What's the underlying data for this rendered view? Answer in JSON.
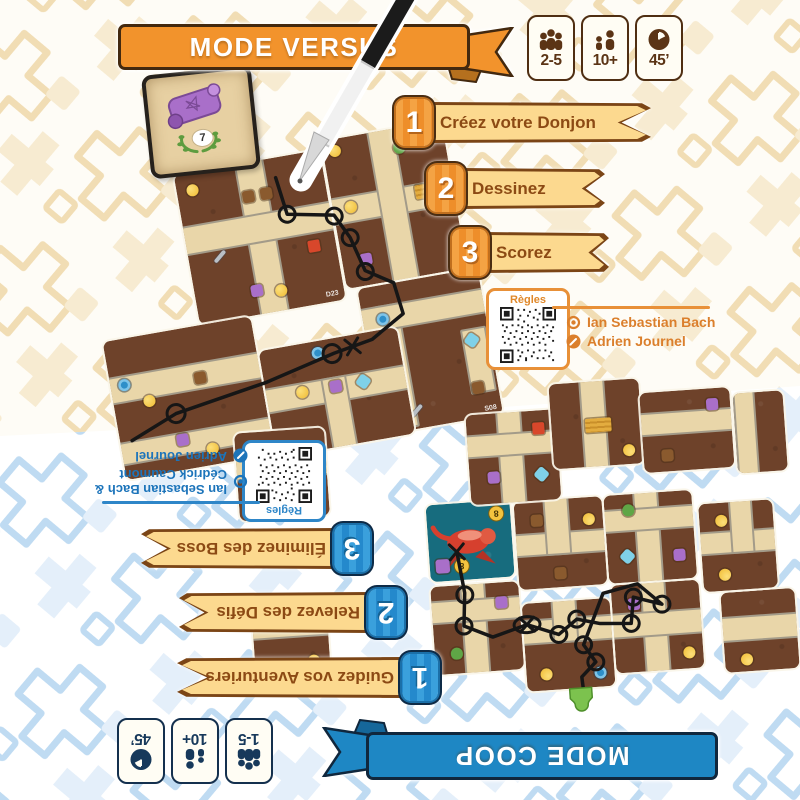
{
  "versus": {
    "banner_label": "MODE VERSUS",
    "theme_color": "#F2932C",
    "badges": [
      {
        "icon": "players-icon",
        "label": "2-5"
      },
      {
        "icon": "age-icon",
        "label": "10+"
      },
      {
        "icon": "timer-icon",
        "label": "45’"
      }
    ],
    "steps": [
      {
        "num": "1",
        "label": "Créez votre Donjon"
      },
      {
        "num": "2",
        "label": "Dessinez"
      },
      {
        "num": "3",
        "label": "Scorez"
      }
    ],
    "qr_label": "Règles",
    "credits": [
      {
        "icon": "target-icon",
        "text": "Ian Sebastian Bach"
      },
      {
        "icon": "pen-icon",
        "text": "Adrien Journel"
      }
    ],
    "tile_codes": [
      "D23",
      "D07",
      "S08",
      "S01"
    ],
    "scroll_card_value": "7"
  },
  "coop": {
    "banner_label": "MODE COOP",
    "theme_color": "#1E87C4",
    "badges": [
      {
        "icon": "players-icon",
        "label": "1-5"
      },
      {
        "icon": "age-icon",
        "label": "10+"
      },
      {
        "icon": "timer-icon",
        "label": "45’"
      }
    ],
    "steps": [
      {
        "num": "1",
        "label": "Guidez vos Aventuriers"
      },
      {
        "num": "2",
        "label": "Relevez des Défis"
      },
      {
        "num": "3",
        "label": "Éliminez des Boss"
      }
    ],
    "qr_label": "Règles",
    "credits": [
      {
        "icon": "target-icon",
        "text": "Ian Sebastian Bach & Cédrick Caumont"
      },
      {
        "icon": "pen-icon",
        "text": "Adrien Journel"
      }
    ],
    "boss_coins": [
      "8",
      "8"
    ]
  },
  "colors": {
    "versus_accent": "#F2932C",
    "coop_accent": "#1E87C4",
    "step_banner_fill": "#FCD98F",
    "step_text": "#8C4A14",
    "tile_room": "#6E422A",
    "tile_corridor": "#E9D6A9",
    "boss_tile": "#176C7E",
    "pattern_top": "#F1DDB4",
    "pattern_bottom": "#BFDBF2"
  }
}
